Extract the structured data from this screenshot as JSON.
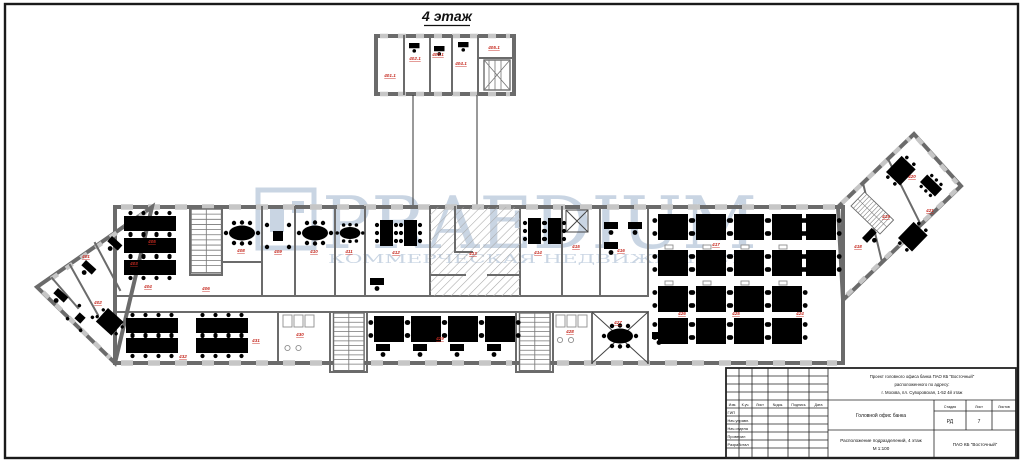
{
  "sheet": {
    "floor_title": "4 этаж"
  },
  "watermark": {
    "brand": "PRAEDIUM",
    "subtitle": "КОММЕРЧЕСКАЯ НЕДВИЖИМОСТЬ",
    "color": "#c4d1e1"
  },
  "colors": {
    "room_label_red": "#c62a20",
    "wall_gray": "#6b6b6b",
    "window_gray": "#c6c6c6",
    "frame_black": "#1a1a1a"
  },
  "title_block": {
    "project_line1": "Проект головного офиса банка ПАО КБ \"Восточный\"",
    "project_line2": "расположенного по адресу:",
    "project_line3": "г. Москва, пл. Суворовская, 1-52 4й этаж",
    "object_name": "Головной офис банка",
    "sheet_name_line1": "Расположение подразделений, 4 этаж",
    "sheet_name_line2": "М 1:100",
    "company": "ПАО КБ \"Восточный\"",
    "stage_label": "Стадия",
    "sheet_label": "Лист",
    "sheets_label": "Листов",
    "stage_value": "РД",
    "sheet_value": "7",
    "sheets_value": "",
    "rev_headers": [
      "Изм.",
      "К.уч.",
      "Лист",
      "№док.",
      "Подпись",
      "Дата"
    ],
    "sign_rows": [
      "ГИП",
      "Нач.управл.",
      "Нач.отдела",
      "Проверил",
      "Разработал"
    ]
  },
  "rooms": [
    {
      "n": "401.1"
    },
    {
      "n": "402.1"
    },
    {
      "n": "403.1"
    },
    {
      "n": "404.1"
    },
    {
      "n": "405.1"
    },
    {
      "n": "401"
    },
    {
      "n": "402"
    },
    {
      "n": "403"
    },
    {
      "n": "404"
    },
    {
      "n": "405"
    },
    {
      "n": "406"
    },
    {
      "n": "408"
    },
    {
      "n": "409"
    },
    {
      "n": "410"
    },
    {
      "n": "411"
    },
    {
      "n": "412"
    },
    {
      "n": "413"
    },
    {
      "n": "414"
    },
    {
      "n": "415"
    },
    {
      "n": "416"
    },
    {
      "n": "417"
    },
    {
      "n": "418"
    },
    {
      "n": "419"
    },
    {
      "n": "420"
    },
    {
      "n": "421"
    },
    {
      "n": "424"
    },
    {
      "n": "425"
    },
    {
      "n": "426"
    },
    {
      "n": "427"
    },
    {
      "n": "428"
    },
    {
      "n": "429"
    },
    {
      "n": "430"
    },
    {
      "n": "431"
    },
    {
      "n": "432"
    }
  ]
}
